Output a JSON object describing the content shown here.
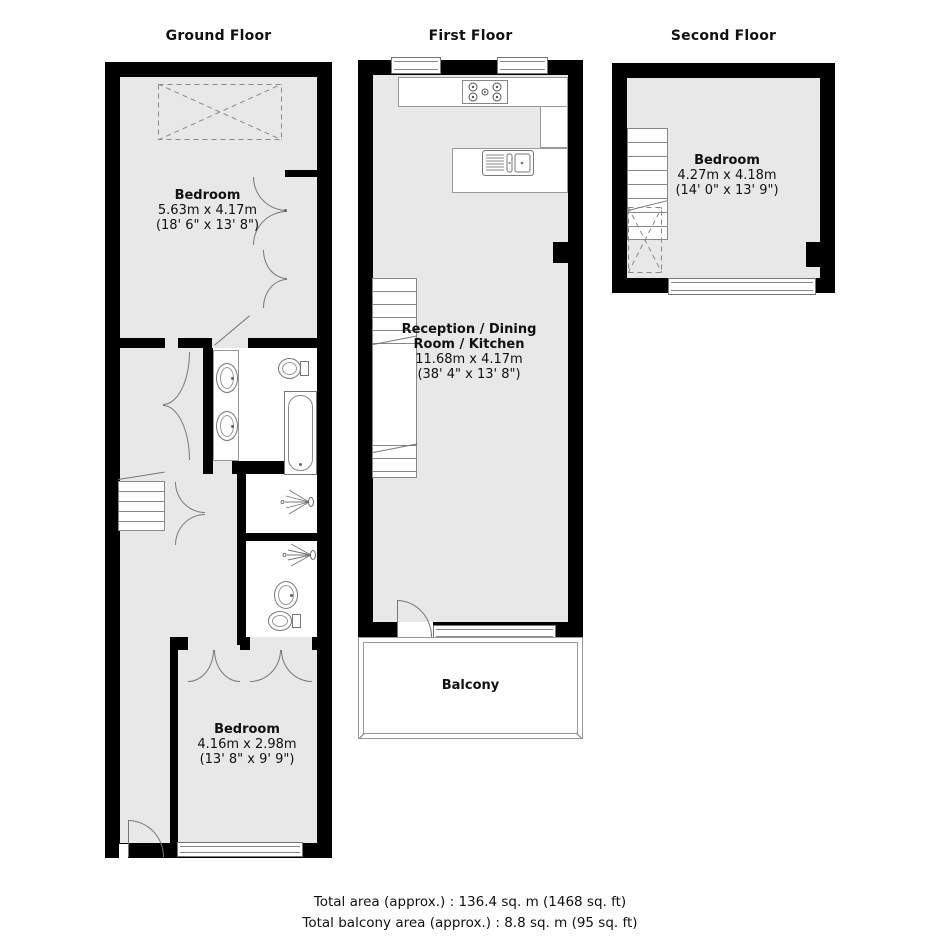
{
  "floors": {
    "ground": {
      "title": "Ground Floor",
      "bedroom_top": {
        "name": "Bedroom",
        "metric": "5.63m x 4.17m",
        "imperial": "(18' 6\" x 13' 8\")"
      },
      "bedroom_bottom": {
        "name": "Bedroom",
        "metric": "4.16m x 2.98m",
        "imperial": "(13' 8\" x 9' 9\")"
      }
    },
    "first": {
      "title": "First Floor",
      "reception": {
        "name": "Reception / Dining Room / Kitchen",
        "metric": "11.68m x 4.17m",
        "imperial": "(38' 4\" x 13' 8\")"
      },
      "balcony": {
        "name": "Balcony"
      }
    },
    "second": {
      "title": "Second Floor",
      "bedroom": {
        "name": "Bedroom",
        "metric": "4.27m x 4.18m",
        "imperial": "(14' 0\" x 13' 9\")"
      }
    }
  },
  "footer": {
    "total_area": "Total area (approx.) : 136.4 sq. m (1468 sq. ft)",
    "total_balcony_area": "Total balcony area (approx.) : 8.8 sq. m (95 sq. ft)"
  },
  "colors": {
    "wall": "#000000",
    "floor_fill": "#e8e8e8",
    "outline": "#777777"
  }
}
